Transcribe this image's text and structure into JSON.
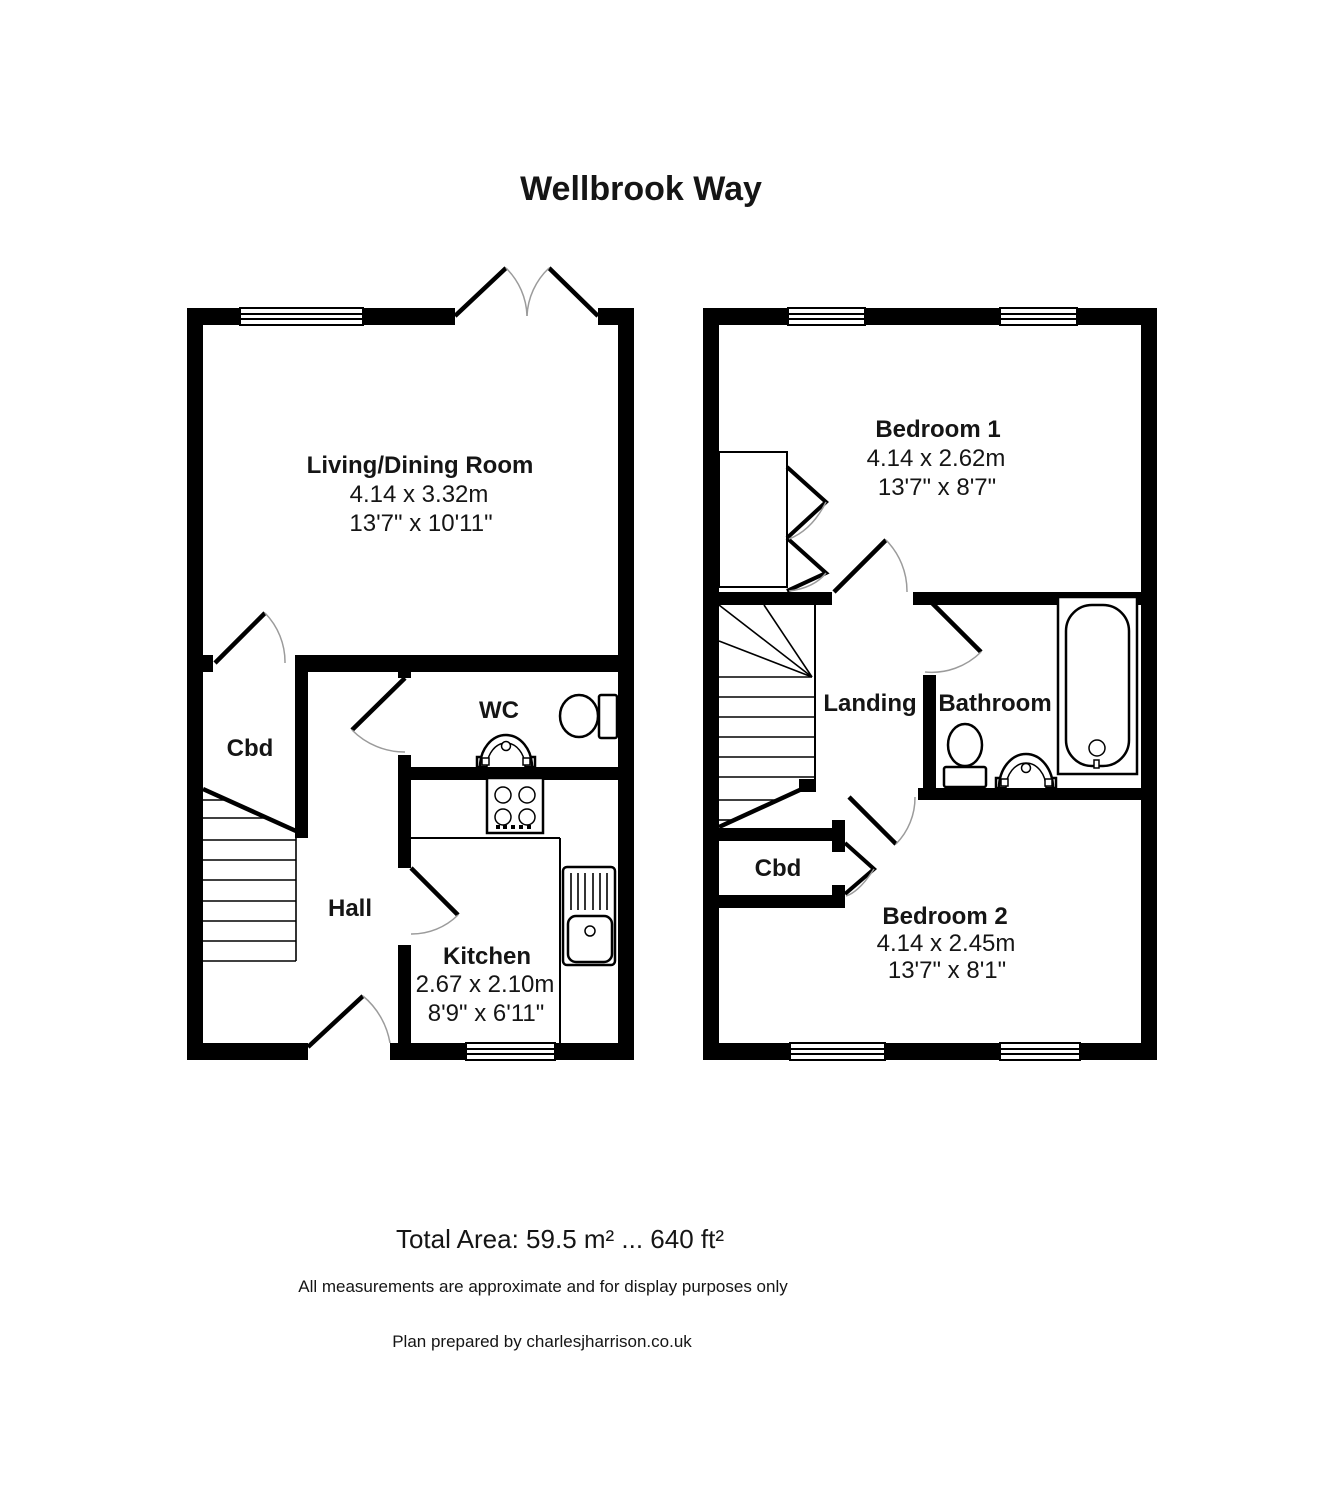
{
  "title": "Wellbrook Way",
  "ground_floor": {
    "living": {
      "name": "Living/Dining Room",
      "metric": "4.14 x 3.32m",
      "imperial": "13'7\" x 10'11\""
    },
    "wc": {
      "name": "WC"
    },
    "cupboard": {
      "name": "Cbd"
    },
    "hall": {
      "name": "Hall"
    },
    "kitchen": {
      "name": "Kitchen",
      "metric": "2.67 x 2.10m",
      "imperial": "8'9\" x 6'11\""
    }
  },
  "first_floor": {
    "bedroom1": {
      "name": "Bedroom 1",
      "metric": "4.14 x 2.62m",
      "imperial": "13'7\" x 8'7\""
    },
    "landing": {
      "name": "Landing"
    },
    "bathroom": {
      "name": "Bathroom"
    },
    "cupboard": {
      "name": "Cbd"
    },
    "bedroom2": {
      "name": "Bedroom 2",
      "metric": "4.14 x 2.45m",
      "imperial": "13'7\" x 8'1\""
    }
  },
  "footer": {
    "total_area": "Total Area: 59.5 m² ... 640 ft²",
    "disclaimer": "All measurements are approximate and for display purposes only",
    "credit": "Plan prepared by charlesjharrison.co.uk"
  },
  "colors": {
    "wall": "#000000",
    "swing_arc": "#9b9b9b",
    "background": "#ffffff",
    "text": "#151515"
  }
}
